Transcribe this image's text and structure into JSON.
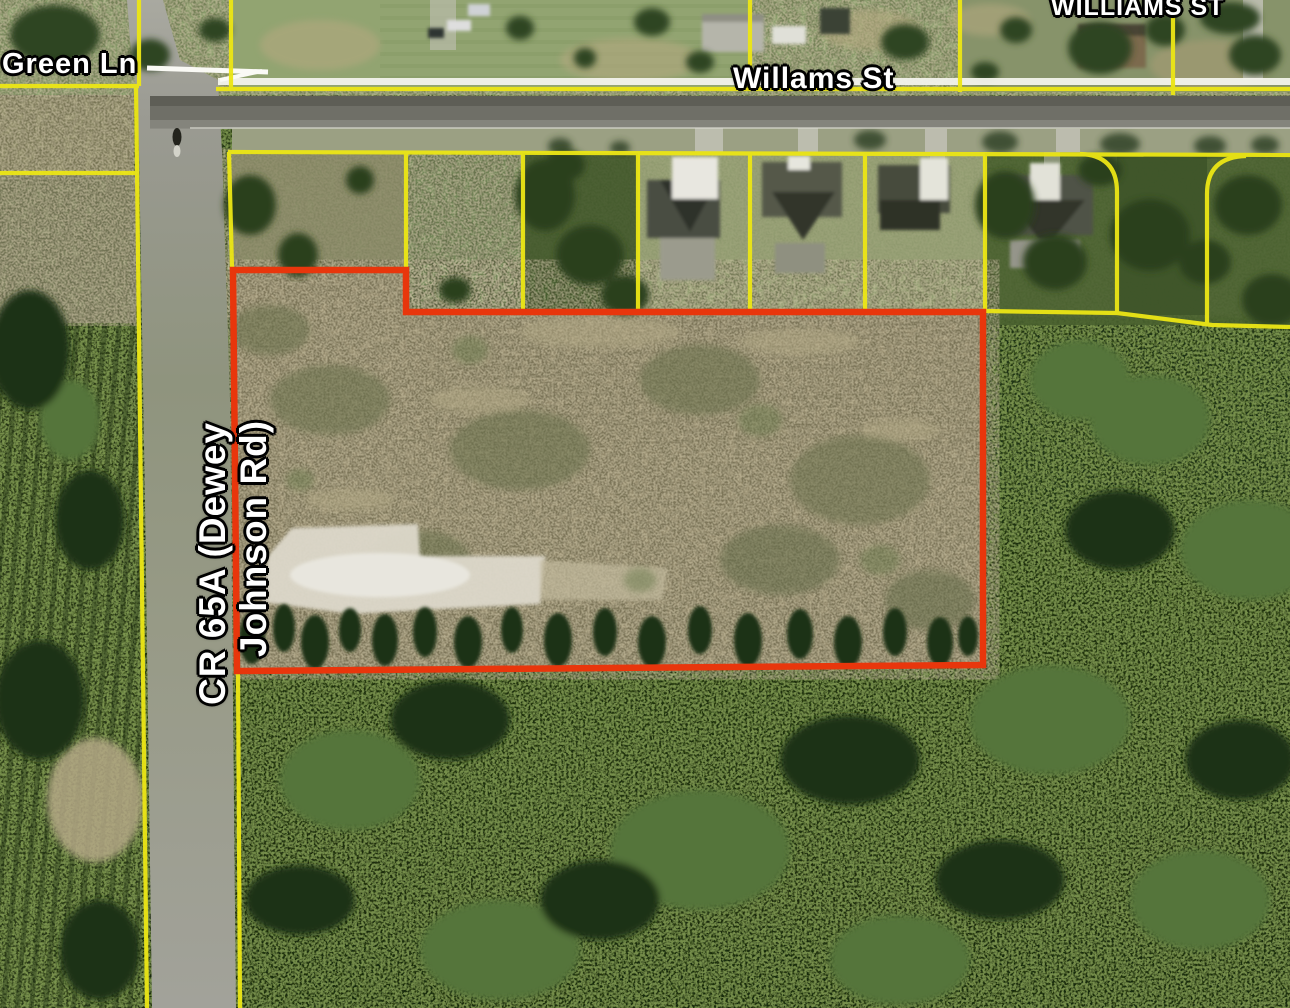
{
  "map": {
    "labels": {
      "green_ln": "Green Ln",
      "willams_st": "Willams St",
      "williams_st_upper": "WILLIAMS ST",
      "cr65a_line1": "CR 65A (Dewey",
      "cr65a_line2": "Johnson Rd)"
    },
    "colors": {
      "parcel_line": "#ece615",
      "highlight_outline": "#e8360c",
      "road_marking": "#f3f3ec",
      "label_text": "#ffffff",
      "label_halo": "#000000"
    }
  }
}
